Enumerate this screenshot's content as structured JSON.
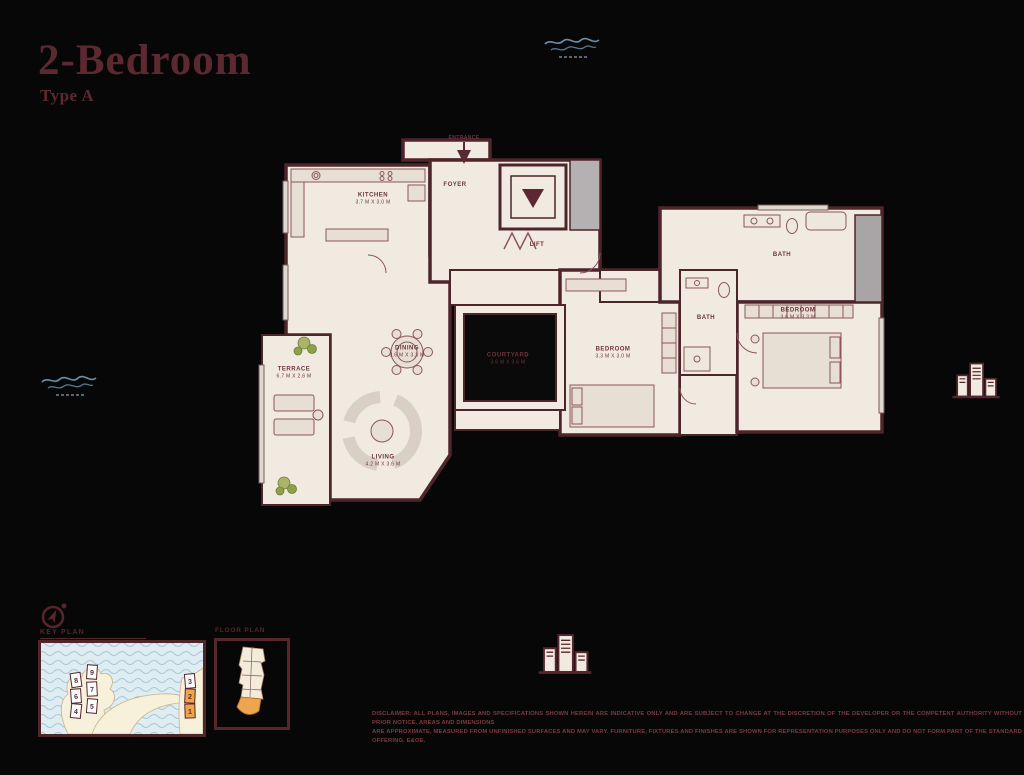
{
  "header": {
    "title": "2-Bedroom",
    "subtitle": "Type A"
  },
  "floorplan": {
    "entrance_label": "ENTRANCE",
    "rooms": [
      {
        "name": "KITCHEN",
        "dims": "3.7 M X 3.0 M"
      },
      {
        "name": "FOYER",
        "dims": ""
      },
      {
        "name": "LIFT",
        "dims": ""
      },
      {
        "name": "DINING",
        "dims": "3.6 M X 3.3 M"
      },
      {
        "name": "LIVING",
        "dims": "4.2 M X 3.6 M"
      },
      {
        "name": "TERRACE",
        "dims": "6.7 M X 2.6 M"
      },
      {
        "name": "COURTYARD",
        "dims": "3.6 M X 3.6 M"
      },
      {
        "name": "BEDROOM",
        "dims": "3.6 M X 3.3 M"
      },
      {
        "name": "BATH",
        "dims": ""
      },
      {
        "name": "BEDROOM",
        "dims": "3.3 M X 3.0 M"
      },
      {
        "name": "BATH",
        "dims": ""
      }
    ]
  },
  "key_plan": {
    "title": "KEY PLAN",
    "markers": [
      {
        "n": "8"
      },
      {
        "n": "6"
      },
      {
        "n": "4"
      },
      {
        "n": "9"
      },
      {
        "n": "7"
      },
      {
        "n": "5"
      },
      {
        "n": "3"
      },
      {
        "n": "2"
      },
      {
        "n": "1"
      }
    ],
    "highlighted_units": "1, 2"
  },
  "floor_box": {
    "title": "FLOOR PLAN"
  },
  "disclaimer": {
    "line1": "DISCLAIMER: ALL PLANS, IMAGES AND SPECIFICATIONS SHOWN HEREIN ARE INDICATIVE ONLY AND ARE SUBJECT TO CHANGE AT THE DISCRETION OF THE DEVELOPER OR THE COMPETENT AUTHORITY WITHOUT PRIOR NOTICE. AREAS AND DIMENSIONS",
    "line2": "ARE APPROXIMATE, MEASURED FROM UNFINISHED SURFACES AND MAY VARY. FURNITURE, FIXTURES AND FINISHES ARE SHOWN FOR REPRESENTATION PURPOSES ONLY AND DO NOT FORM PART OF THE STANDARD OFFERING. E&OE."
  },
  "colors": {
    "maroon": "#5c2831",
    "floor_beige": "#f1eae1",
    "highlight_orange": "#eda64e",
    "water_blue": "#dfedf2",
    "watermark_blue": "#7aa6c6",
    "sand": "#f7f0da",
    "plant_green": "#8da04e"
  }
}
